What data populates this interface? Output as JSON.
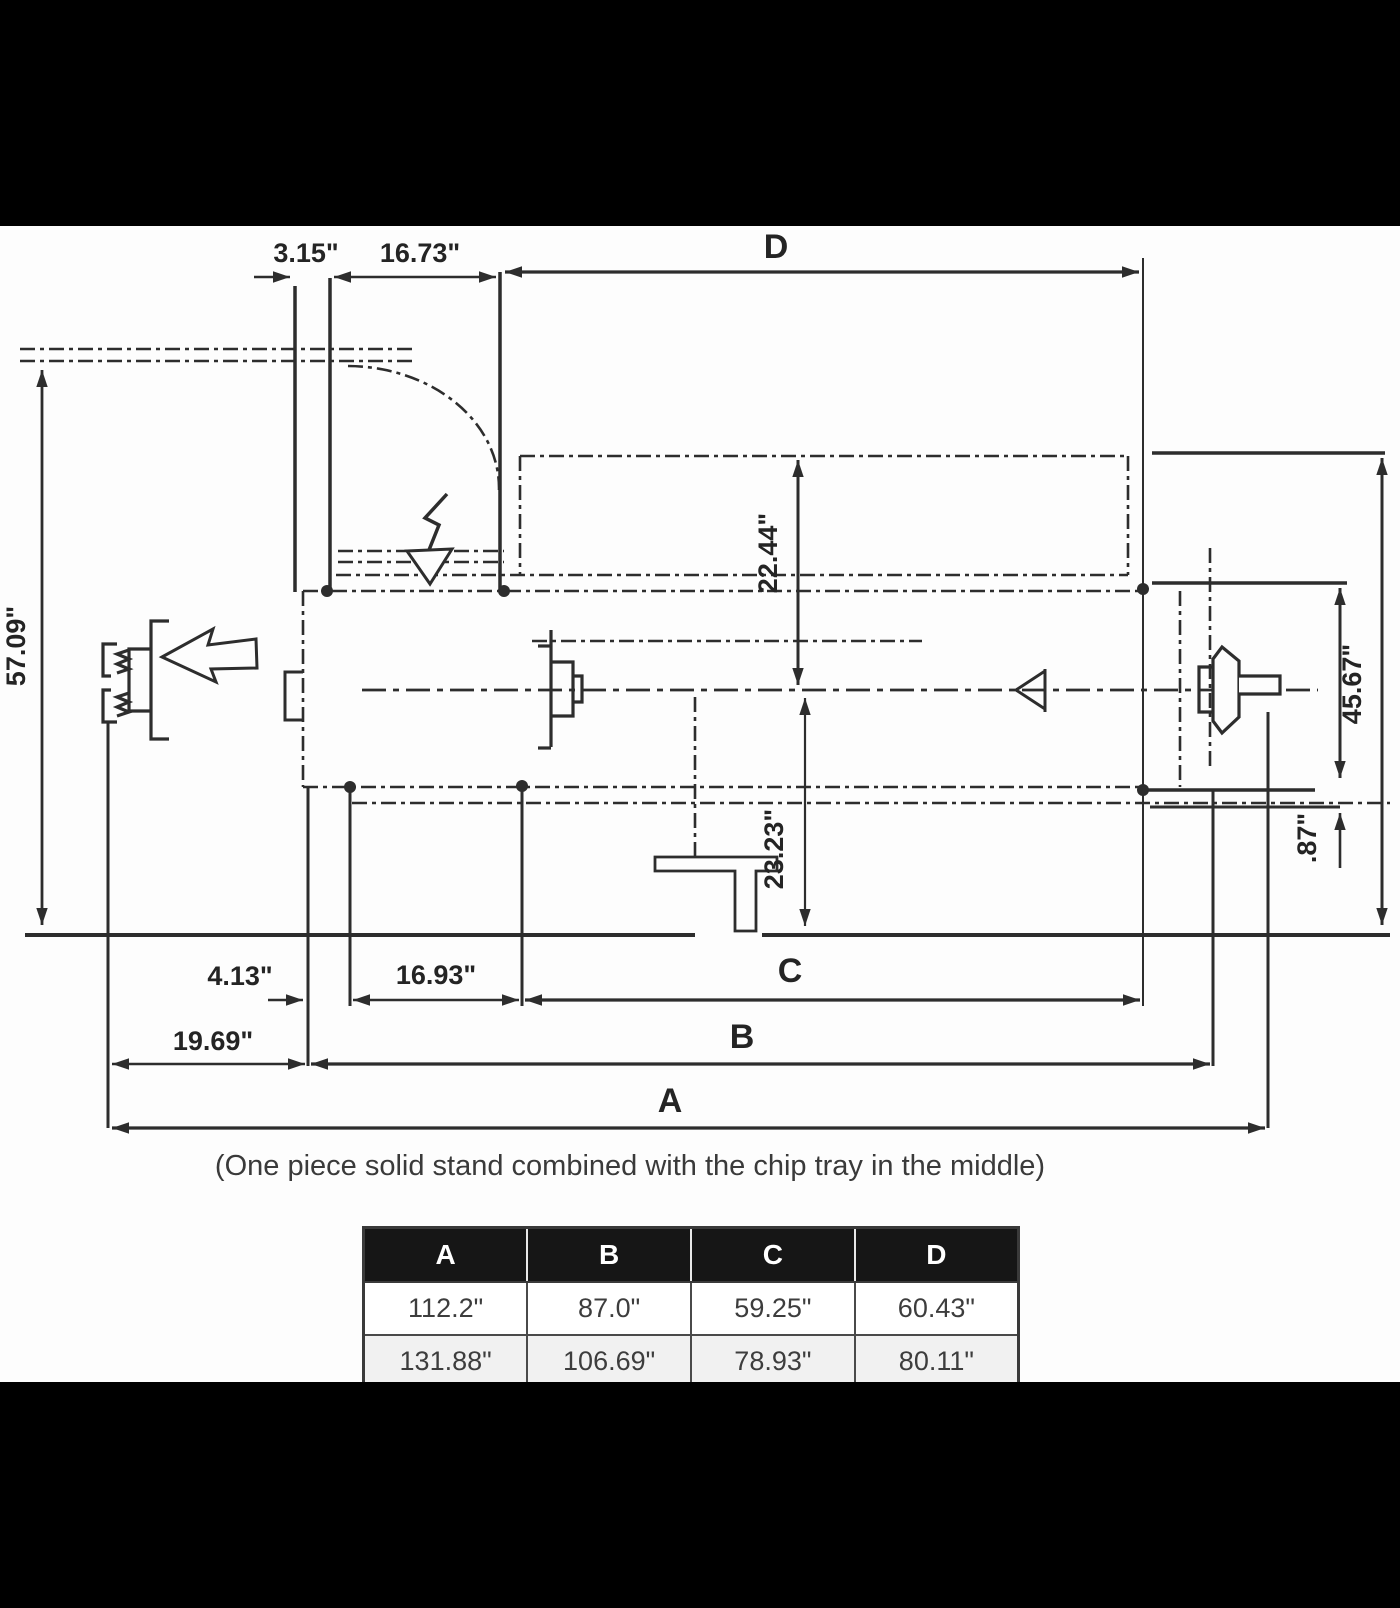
{
  "colors": {
    "letterbox": "#000000",
    "paper": "#fdfdfd",
    "line": "#2d2d2d",
    "table_header_bg": "#161616",
    "table_header_text": "#ffffff",
    "table_alt_row_bg": "#f1f1f1"
  },
  "drawing": {
    "caption": "(One piece solid stand combined with the chip tray in the middle)",
    "dims": {
      "offset_top": "3.15\"",
      "door_top": "16.73\"",
      "span_d": "D",
      "height_left": "57.09\"",
      "center_to_top": "22.44\"",
      "center_to_floor": "23.23\"",
      "height_right": "45.67\"",
      "bed_lip": ".87\"",
      "offset_bottom": "4.13\"",
      "door_bottom": "16.93\"",
      "span_c": "C",
      "stand_offset": "19.69\"",
      "span_b": "B",
      "span_a": "A"
    },
    "symbols": [
      "door-swing-arc",
      "power-cable-arrow",
      "leadscrew-handwheel",
      "pull-direction-arrow",
      "spindle-chuck",
      "quill-direction-arrow",
      "tailstock-handwheel",
      "chip-tray-foot"
    ]
  },
  "table": {
    "headers": [
      "A",
      "B",
      "C",
      "D"
    ],
    "rows": [
      [
        "112.2\"",
        "87.0\"",
        "59.25\"",
        "60.43\""
      ],
      [
        "131.88\"",
        "106.69\"",
        "78.93\"",
        "80.11\""
      ]
    ]
  }
}
